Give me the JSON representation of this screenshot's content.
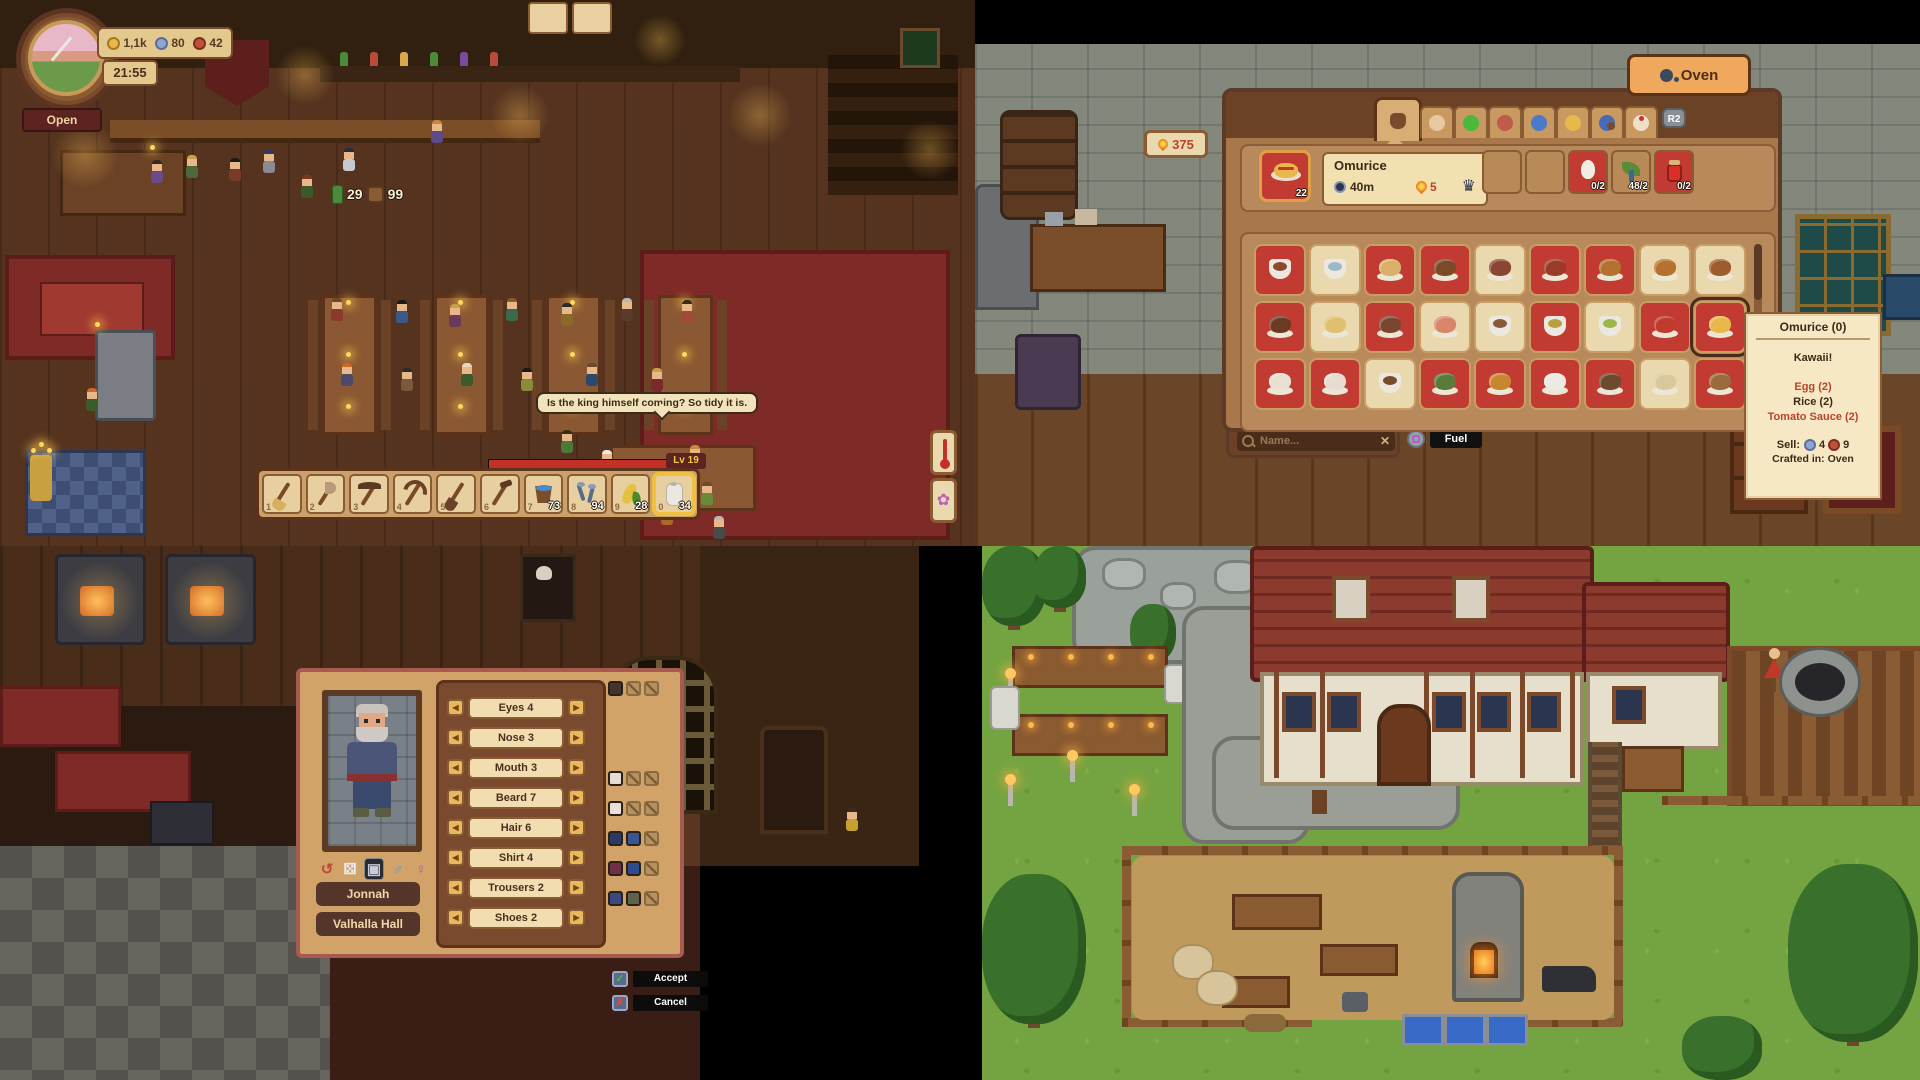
{
  "tavern": {
    "clock_time": "21:55",
    "currencies": [
      {
        "name": "gold-coin",
        "value": "1,1k",
        "color": "#e8b84a",
        "edge": "#a87820"
      },
      {
        "name": "silver-coin",
        "value": "80",
        "color": "#8ea6d4",
        "edge": "#5a6e9a"
      },
      {
        "name": "copper-coin",
        "value": "42",
        "color": "#c0503a",
        "edge": "#7e2e1e"
      }
    ],
    "open_sign": "Open",
    "capacity": {
      "current": "29",
      "max": "99"
    },
    "speech_bubble": "Is the king himself coming? So tidy it is.",
    "level_label": "Lv 19",
    "hotbar_slots": [
      {
        "key": "1",
        "item": "broom"
      },
      {
        "key": "2",
        "item": "axe"
      },
      {
        "key": "3",
        "item": "pickaxe"
      },
      {
        "key": "4",
        "item": "sickle"
      },
      {
        "key": "5",
        "item": "shovel"
      },
      {
        "key": "6",
        "item": "hoe"
      },
      {
        "key": "7",
        "item": "bucket",
        "count": "73"
      },
      {
        "key": "8",
        "item": "nails",
        "count": "94"
      },
      {
        "key": "9",
        "item": "corn",
        "count": "28"
      },
      {
        "key": "0",
        "item": "paper-roll",
        "count": "34",
        "selected": true
      }
    ],
    "side_buttons": [
      {
        "name": "thermometer"
      },
      {
        "name": "flower",
        "glyph": "✿",
        "color": "#b860b8"
      }
    ]
  },
  "oven_panel": {
    "title": "Oven",
    "fuel_badge": "375",
    "tab_shortcut": "R2",
    "tabs": [
      {
        "name": "cooking-pot",
        "active": true,
        "color": "#7a4a2e"
      },
      {
        "name": "tapas",
        "color": "#e8c8a0"
      },
      {
        "name": "vegetables",
        "color": "#4ab83a"
      },
      {
        "name": "meat",
        "color": "#c05a4a"
      },
      {
        "name": "fish",
        "color": "#4a7ac8"
      },
      {
        "name": "pasta",
        "color": "#e8b84a"
      },
      {
        "name": "soups",
        "color": "#4a6ab8"
      },
      {
        "name": "desserts",
        "color": "#f0e0c8"
      }
    ],
    "selected_recipe": {
      "name": "Omurice",
      "stack": "22",
      "time": "40m",
      "fuel_cost": "5"
    },
    "ingredient_slots": [
      {
        "type": "empty"
      },
      {
        "type": "empty"
      },
      {
        "item": "egg",
        "count": "0/2",
        "sufficient": false
      },
      {
        "item": "rice",
        "count": "48/2",
        "sufficient": true
      },
      {
        "item": "tomato-sauce",
        "count": "0/2",
        "sufficient": false
      }
    ],
    "search": {
      "placeholder": "Name..."
    },
    "clear_glyph": "✕",
    "fuel_label": "Fuel",
    "recipes_grid": [
      {
        "name": "goulash",
        "slot": "red",
        "color": "#8a4a2e",
        "kind": "bowl"
      },
      {
        "name": "tea",
        "slot": "cream",
        "color": "#9db8c8",
        "kind": "bowl"
      },
      {
        "name": "spring-roll",
        "slot": "red",
        "color": "#d8b06a"
      },
      {
        "name": "skewer",
        "slot": "red",
        "color": "#7a4a2a"
      },
      {
        "name": "steak",
        "slot": "cream",
        "color": "#8a4632"
      },
      {
        "name": "sausage",
        "slot": "red",
        "color": "#9a3a28"
      },
      {
        "name": "burger",
        "slot": "red",
        "color": "#b5712f"
      },
      {
        "name": "cheeseburger",
        "slot": "cream",
        "color": "#b5712f"
      },
      {
        "name": "bread-bun",
        "slot": "cream",
        "color": "#9c5c2c"
      },
      {
        "name": "meat-skewers",
        "slot": "red",
        "color": "#6b3a22"
      },
      {
        "name": "fries",
        "slot": "cream",
        "color": "#e0c070"
      },
      {
        "name": "sweet-potato",
        "slot": "red",
        "color": "#7a4630"
      },
      {
        "name": "tomato-bread",
        "slot": "cream",
        "color": "#d8866a"
      },
      {
        "name": "brown-soup",
        "slot": "cream",
        "color": "#8a5a38",
        "kind": "bowl"
      },
      {
        "name": "yellow-soup",
        "slot": "red",
        "color": "#b8a040",
        "kind": "bowl"
      },
      {
        "name": "green-soup",
        "slot": "cream",
        "color": "#9ab84a",
        "kind": "bowl"
      },
      {
        "name": "salad",
        "slot": "red",
        "color": "#c03a2e"
      },
      {
        "name": "omurice",
        "slot": "red",
        "color": "#e8b84a",
        "selected": true
      },
      {
        "name": "cream-dish",
        "slot": "red",
        "color": "#e8e0d0"
      },
      {
        "name": "parfait",
        "slot": "red",
        "color": "#e8dcd0"
      },
      {
        "name": "stew-bowl",
        "slot": "cream",
        "color": "#7a4a2c",
        "kind": "bowl"
      },
      {
        "name": "meat-salad",
        "slot": "red",
        "color": "#5a7a3a"
      },
      {
        "name": "corn-dog",
        "slot": "red",
        "color": "#c8862e"
      },
      {
        "name": "onigiri",
        "slot": "red",
        "color": "#eceae2"
      },
      {
        "name": "stir-fry",
        "slot": "red",
        "color": "#6b4a2e"
      },
      {
        "name": "pizza",
        "slot": "cream",
        "color": "#d8c89a"
      },
      {
        "name": "meatloaf",
        "slot": "red",
        "color": "#9a6a3a"
      }
    ],
    "tooltip": {
      "title": "Omurice (0)",
      "flavor": "Kawaii!",
      "ingredients": [
        {
          "text": "Egg (2)",
          "missing": true
        },
        {
          "text": "Rice (2)",
          "missing": false
        },
        {
          "text": "Tomato Sauce (2)",
          "missing": true
        }
      ],
      "sell_label": "Sell:",
      "sell_values": [
        {
          "coin": "silver-coin",
          "value": "4",
          "color": "#8ea6d4",
          "edge": "#5a6e9a"
        },
        {
          "coin": "copper-coin",
          "value": "9",
          "color": "#c0503a",
          "edge": "#7e2e1e"
        }
      ],
      "crafted_in": "Crafted in: Oven"
    }
  },
  "character_panel": {
    "portrait_name": "Jonnah",
    "portrait_location": "Valhalla Hall",
    "feature_rows": [
      {
        "label": "Eyes 4",
        "colors": [
          "#46342b"
        ],
        "locked": 2
      },
      {
        "label": "Nose 3",
        "colors": [],
        "locked": 0
      },
      {
        "label": "Mouth 3",
        "colors": [],
        "locked": 0
      },
      {
        "label": "Beard 7",
        "colors": [
          "#e6dcd6"
        ],
        "locked": 2
      },
      {
        "label": "Hair 6",
        "colors": [
          "#eadfd9"
        ],
        "locked": 2
      },
      {
        "label": "Shirt 4",
        "colors": [
          "#2c3a63",
          "#3a5494"
        ],
        "locked": 1
      },
      {
        "label": "Trousers 2",
        "colors": [
          "#713048",
          "#2f4b8f"
        ],
        "locked": 1
      },
      {
        "label": "Shoes 2",
        "colors": [
          "#3a4a80",
          "#5f6148"
        ],
        "locked": 1
      }
    ],
    "portrait_tools": [
      {
        "name": "reset",
        "glyph": "↺",
        "color": "#c04838"
      },
      {
        "name": "randomize-dice",
        "glyph": "⚄",
        "color": "#e8ecf4"
      },
      {
        "name": "portrait-toggle",
        "glyph": "▣",
        "color": "#c8ccd8",
        "active": true
      },
      {
        "name": "male-symbol",
        "glyph": "♂",
        "color": "#5a9ad8"
      },
      {
        "name": "female-symbol",
        "glyph": "♀",
        "color": "#b05ab0"
      }
    ],
    "accept_label": "Accept",
    "accept_glyph": "✓",
    "cancel_label": "Cancel",
    "cancel_glyph": "✗"
  }
}
